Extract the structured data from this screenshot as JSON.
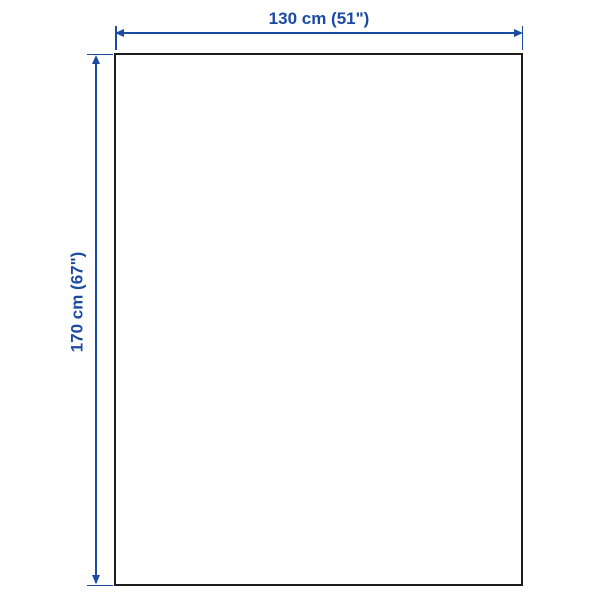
{
  "diagram": {
    "type": "product-dimension-diagram",
    "dimensions": {
      "width": {
        "label": "130 cm (51\")"
      },
      "height": {
        "label": "170 cm (67\")"
      }
    }
  },
  "colors": {
    "accent": "#1a4ba3",
    "outline": "#1c1c1c",
    "background": "#ffffff"
  }
}
